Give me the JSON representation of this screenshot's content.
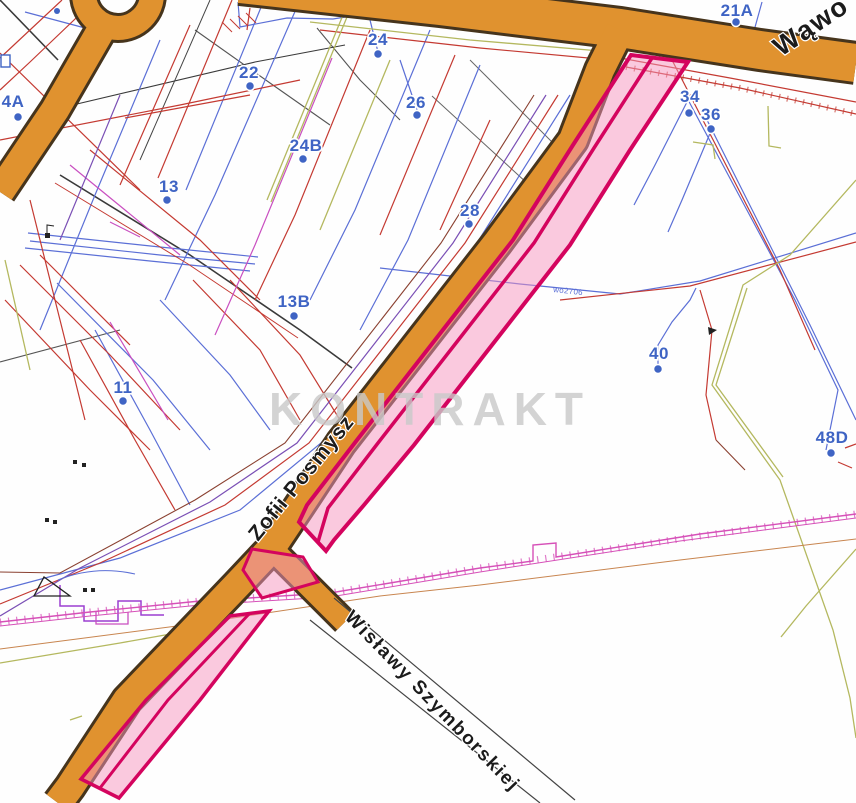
{
  "map": {
    "watermark_text": "KONTRAKT",
    "streets": {
      "main_diagonal": "Zofii Posmysz",
      "branch_southeast": "Wisławy Szymborskiej",
      "top_partial": "Wąwo"
    },
    "address_labels": [
      {
        "text": "4A"
      },
      {
        "text": "21A"
      },
      {
        "text": "22"
      },
      {
        "text": "24"
      },
      {
        "text": "26"
      },
      {
        "text": "24B"
      },
      {
        "text": "13"
      },
      {
        "text": "28"
      },
      {
        "text": "13B"
      },
      {
        "text": "11"
      },
      {
        "text": "34"
      },
      {
        "text": "36"
      },
      {
        "text": "40"
      },
      {
        "text": "48D"
      }
    ],
    "utility_labels": [
      {
        "text": "wo2706"
      }
    ],
    "colors": {
      "road_fill": "#e0922f",
      "road_edge": "#46341c",
      "parcel_fill": "#f593bd",
      "parcel_border": "#d4045e",
      "address_blue": "#3f64c4",
      "watermark_gray": "#c9c9c9",
      "street_text": "#1b1b1b",
      "fence_magenta": "#d650b8"
    }
  }
}
